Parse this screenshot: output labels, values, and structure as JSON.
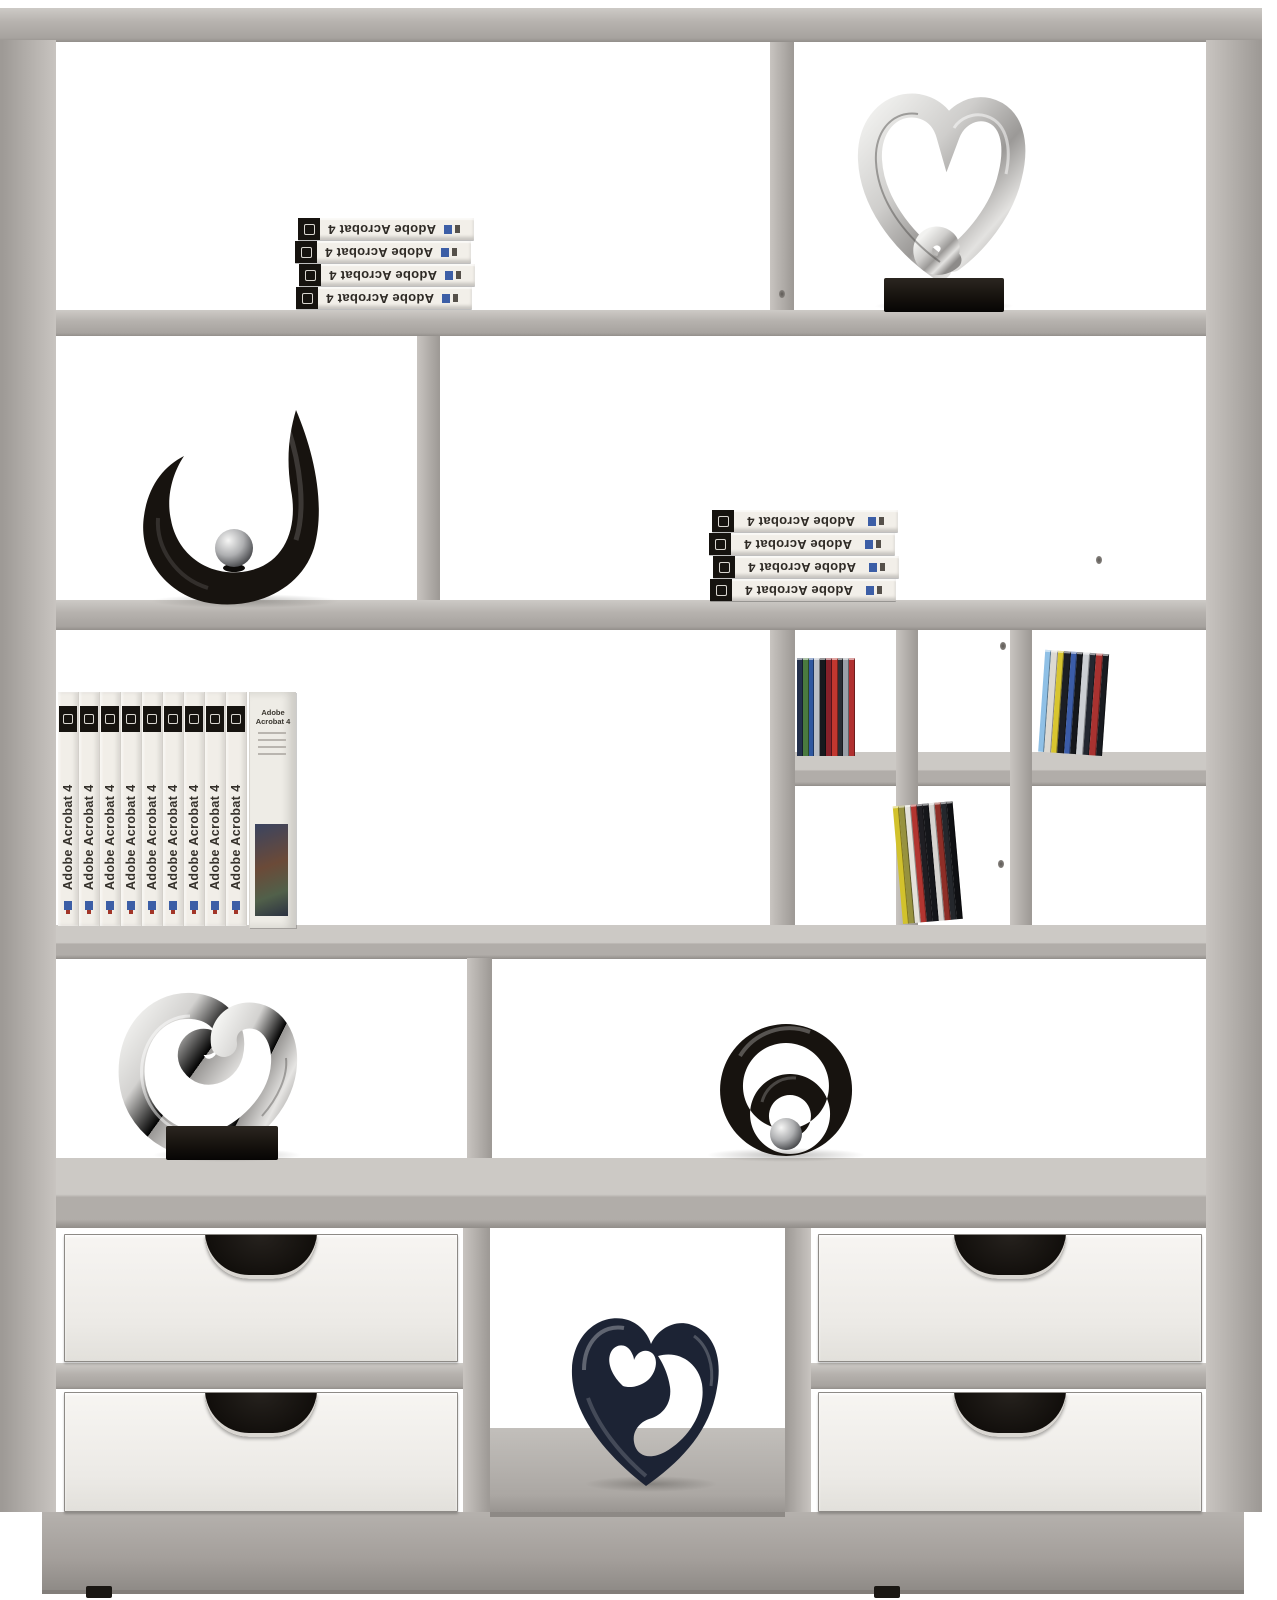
{
  "scene": {
    "type": "product-photo",
    "subject": "Concrete-look shelf room divider with white drawers and decorative objects",
    "background": "#ffffff"
  },
  "palette": {
    "concrete": "#b3afab",
    "concrete_light": "#ccc9c5",
    "concrete_dark": "#938f8b",
    "plinth": "#a8a4a0",
    "drawer_white": "#f3f1ee",
    "seam_dark": "#8d8a86",
    "base_black": "#16120e",
    "gloss_black": "#17130f",
    "silver": "#d9d8d6",
    "chrome_ball": "#b9babc",
    "navy": "#1c2334",
    "book_spine_white": "#f1eee8",
    "brand_blue": "#3c5ea6"
  },
  "books": {
    "title": "Adobe Acrobat 4",
    "row1_stack_count": 4,
    "row2_stack_count": 4,
    "row3_spine_count": 9,
    "row3_cover_count": 1
  },
  "cds": {
    "group1_colors": [
      "#23304c",
      "#4a7a3f",
      "#2e57a0",
      "#b9bec6",
      "#17191e",
      "#87212a",
      "#c2372f",
      "#2a2d33",
      "#9aa0a8",
      "#b03030"
    ],
    "group2_colors": [
      "#8fc0e6",
      "#dcd9d2",
      "#d8c52f",
      "#1c1e24",
      "#3b5ca8",
      "#15171b",
      "#cccfd3",
      "#232730",
      "#a93230",
      "#191b20"
    ],
    "group3_colors": [
      "#d2c22c",
      "#97923e",
      "#e4e1d9",
      "#b23530",
      "#1f1e23",
      "#15161a",
      "#d5d3cf",
      "#8e2e27",
      "#24272c",
      "#0f1013"
    ]
  },
  "objects": {
    "row1_right": "silver heart sculpture on black base",
    "row2_left": "black abstract horn sculpture with chrome ball",
    "row4_left": "silver swirl heart sculpture on black base",
    "row4_right": "black double-ring sculpture with chrome ball",
    "bottom_middle": "dark blue heart sculpture"
  }
}
